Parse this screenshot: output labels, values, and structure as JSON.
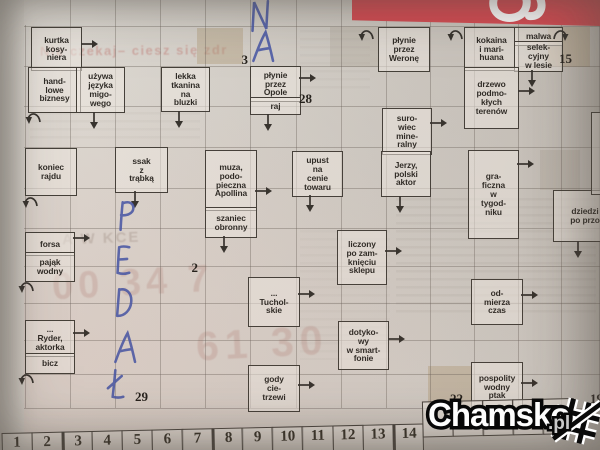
{
  "photo": {
    "paper_color": "#d7d3cc",
    "masthead_color": "#d5434b",
    "ink_color": "#3e4ea3",
    "grid_line_color": "#605a52",
    "cell_border_color": "#3a362f"
  },
  "clues": [
    {
      "text": "kurtka\nkosy-\nniera",
      "x": 31,
      "y": 27,
      "w": 47,
      "h": 40
    },
    {
      "text": "hand-\nlowe\nbiznesy",
      "x": 28,
      "y": 67,
      "w": 49,
      "h": 42
    },
    {
      "text": "używa\njęzyka\nmigo-\nwego",
      "x": 76,
      "y": 67,
      "w": 45,
      "h": 42
    },
    {
      "text": "lekka\ntkanina\nna\nbluzki",
      "x": 161,
      "y": 67,
      "w": 45,
      "h": 41
    },
    {
      "text": "płynie\nprzez\nOpole",
      "x": 250,
      "y": 66,
      "w": 47,
      "h": 32
    },
    {
      "text": "raj",
      "x": 250,
      "y": 97,
      "w": 47,
      "h": 14
    },
    {
      "text": "płynie\nprzez\nWeronę",
      "x": 378,
      "y": 27,
      "w": 48,
      "h": 41
    },
    {
      "text": "kokaina\ni mari-\nhuana",
      "x": 464,
      "y": 27,
      "w": 51,
      "h": 40
    },
    {
      "text": "malwa",
      "x": 514,
      "y": 27,
      "w": 45,
      "h": 15
    },
    {
      "text": "selek-\ncyjny\nw lesie",
      "x": 514,
      "y": 41,
      "w": 45,
      "h": 27
    },
    {
      "text": "drzewo\npodmo-\nkłych\nterenów",
      "x": 464,
      "y": 67,
      "w": 51,
      "h": 58
    },
    {
      "text": "suro-\nwiec\nmine-\nralny",
      "x": 382,
      "y": 108,
      "w": 46,
      "h": 43
    },
    {
      "text": "Jerzy,\npolski\naktor",
      "x": 381,
      "y": 151,
      "w": 46,
      "h": 42
    },
    {
      "text": "koniec\nrajdu",
      "x": 25,
      "y": 148,
      "w": 48,
      "h": 44
    },
    {
      "text": "ssak\nz\ntrąbką",
      "x": 115,
      "y": 147,
      "w": 49,
      "h": 42
    },
    {
      "text": "muza,\npodo-\npieczna\nApollina",
      "x": 205,
      "y": 150,
      "w": 48,
      "h": 57
    },
    {
      "text": "szaniec\nobronny",
      "x": 205,
      "y": 207,
      "w": 48,
      "h": 27
    },
    {
      "text": "upust\nna\ncenie\ntowaru",
      "x": 292,
      "y": 151,
      "w": 47,
      "h": 42
    },
    {
      "text": "gra-\nficzna\nw\ntygod-\nniku",
      "x": 468,
      "y": 150,
      "w": 47,
      "h": 85
    },
    {
      "text": "dziedzi\npo przo",
      "x": 553,
      "y": 190,
      "w": 60,
      "h": 48
    },
    {
      "text": "",
      "x": 591,
      "y": 112,
      "w": 30,
      "h": 79
    },
    {
      "text": "liczony\npo zam-\nknięciu\nsklepu",
      "x": 337,
      "y": 230,
      "w": 46,
      "h": 51
    },
    {
      "text": "forsa",
      "x": 25,
      "y": 232,
      "w": 46,
      "h": 20
    },
    {
      "text": "pająk\nwodny",
      "x": 25,
      "y": 252,
      "w": 46,
      "h": 26
    },
    {
      "text": "...\nTuchol-\nskie",
      "x": 248,
      "y": 277,
      "w": 48,
      "h": 46
    },
    {
      "text": "od-\nmierza\nczas",
      "x": 471,
      "y": 279,
      "w": 48,
      "h": 42
    },
    {
      "text": "dotyko-\nwy\nw smart-\nfonie",
      "x": 338,
      "y": 321,
      "w": 47,
      "h": 45
    },
    {
      "text": "...\nRyder,\naktorka",
      "x": 25,
      "y": 320,
      "w": 46,
      "h": 33
    },
    {
      "text": "bicz",
      "x": 25,
      "y": 353,
      "w": 46,
      "h": 17
    },
    {
      "text": "gody\ncie-\ntrzewi",
      "x": 248,
      "y": 365,
      "w": 48,
      "h": 43
    },
    {
      "text": "pospolity\nwodny\nptak",
      "x": 471,
      "y": 362,
      "w": 48,
      "h": 46
    }
  ],
  "arrows": [
    {
      "type": "right",
      "x": 79,
      "y": 35
    },
    {
      "type": "hook",
      "x": 24,
      "y": 110
    },
    {
      "type": "down",
      "x": 86,
      "y": 110
    },
    {
      "type": "down",
      "x": 171,
      "y": 109
    },
    {
      "type": "right",
      "x": 297,
      "y": 69
    },
    {
      "type": "down",
      "x": 260,
      "y": 112
    },
    {
      "type": "hook",
      "x": 357,
      "y": 27
    },
    {
      "type": "hook",
      "x": 446,
      "y": 27
    },
    {
      "type": "hookr",
      "x": 551,
      "y": 27
    },
    {
      "type": "down",
      "x": 524,
      "y": 68
    },
    {
      "type": "right",
      "x": 516,
      "y": 82
    },
    {
      "type": "right",
      "x": 428,
      "y": 114
    },
    {
      "type": "down",
      "x": 392,
      "y": 194
    },
    {
      "type": "hook",
      "x": 21,
      "y": 194
    },
    {
      "type": "down",
      "x": 127,
      "y": 189
    },
    {
      "type": "right",
      "x": 253,
      "y": 182
    },
    {
      "type": "down",
      "x": 216,
      "y": 234
    },
    {
      "type": "down",
      "x": 302,
      "y": 193
    },
    {
      "type": "right",
      "x": 515,
      "y": 155
    },
    {
      "type": "down",
      "x": 570,
      "y": 239
    },
    {
      "type": "right",
      "x": 383,
      "y": 242
    },
    {
      "type": "right",
      "x": 71,
      "y": 229
    },
    {
      "type": "hook",
      "x": 17,
      "y": 279
    },
    {
      "type": "right",
      "x": 71,
      "y": 324
    },
    {
      "type": "hook",
      "x": 17,
      "y": 371
    },
    {
      "type": "right",
      "x": 296,
      "y": 285
    },
    {
      "type": "right",
      "x": 519,
      "y": 286
    },
    {
      "type": "right",
      "x": 386,
      "y": 330
    },
    {
      "type": "right",
      "x": 296,
      "y": 376
    },
    {
      "type": "right",
      "x": 519,
      "y": 374
    }
  ],
  "cell_numbers": [
    {
      "value": "3",
      "x": 228,
      "y": 52
    },
    {
      "value": "15",
      "x": 552,
      "y": 51
    },
    {
      "value": "28",
      "x": 292,
      "y": 91
    },
    {
      "value": "2",
      "x": 178,
      "y": 260
    },
    {
      "value": "29",
      "x": 128,
      "y": 389
    },
    {
      "value": "22",
      "x": 443,
      "y": 391
    },
    {
      "value": "19",
      "x": 583,
      "y": 391
    }
  ],
  "shaded_cells": [
    {
      "x": 197,
      "y": 28,
      "w": 46,
      "h": 36,
      "light": false
    },
    {
      "x": 548,
      "y": 27,
      "w": 42,
      "h": 40,
      "light": false
    },
    {
      "x": 330,
      "y": 27,
      "w": 48,
      "h": 40,
      "light": true
    },
    {
      "x": 428,
      "y": 366,
      "w": 44,
      "h": 40,
      "light": false
    },
    {
      "x": 540,
      "y": 150,
      "w": 40,
      "h": 40,
      "light": true
    }
  ],
  "handwriting": {
    "ink_color": "#3e4ea3",
    "letters": [
      {
        "ch": "N",
        "x": 248,
        "y": -1
      },
      {
        "ch": "A",
        "x": 251,
        "y": 29
      },
      {
        "ch": "P",
        "x": 115,
        "y": 198
      },
      {
        "ch": "E",
        "x": 112,
        "y": 243
      },
      {
        "ch": "D",
        "x": 111,
        "y": 285
      },
      {
        "ch": "A",
        "x": 113,
        "y": 330
      },
      {
        "ch": "Ł",
        "x": 105,
        "y": 367
      }
    ]
  },
  "legend": {
    "numbers": [
      "1",
      "2",
      "3",
      "4",
      "5",
      "6",
      "7",
      "8",
      "9",
      "10",
      "11",
      "12",
      "13",
      "14",
      "",
      "",
      "",
      "",
      ""
    ],
    "heavy_numbers": [
      "3",
      "8",
      "14"
    ]
  },
  "watermark": {
    "brand": "Chamsko",
    "tld": ".pl"
  },
  "ghost_texts": [
    {
      "text": "Nie czekaj– ciesz się zdr",
      "x": 40,
      "y": 43,
      "size": 13,
      "color": "rgba(178,62,56,.30)",
      "rot": -0.5,
      "spacing": 1.5
    },
    {
      "text": "A W KCE",
      "x": 62,
      "y": 230,
      "size": 15,
      "color": "rgba(118,98,88,.25)",
      "rot": -2,
      "spacing": 2
    },
    {
      "text": "00 34 7",
      "x": 52,
      "y": 262,
      "size": 38,
      "color": "rgba(182,138,128,.33)",
      "rot": -3,
      "spacing": 5
    },
    {
      "text": "61 30",
      "x": 196,
      "y": 320,
      "size": 41,
      "color": "rgba(182,138,128,.33)",
      "rot": -3,
      "spacing": 6
    }
  ]
}
